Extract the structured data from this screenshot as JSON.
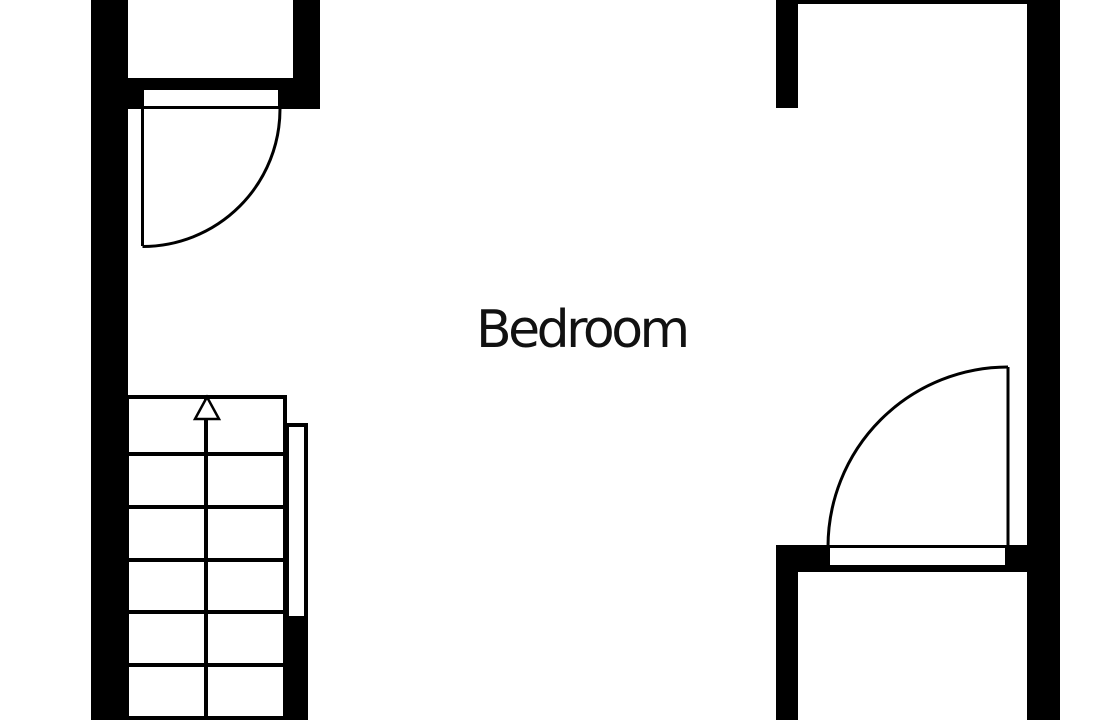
{
  "floorplan": {
    "room_label": "Bedroom",
    "colors": {
      "wall": "#000000",
      "floor": "#ffffff",
      "label_text": "#111111"
    },
    "stairs": {
      "direction": "up",
      "visible_step_rows": 6,
      "columns": 2,
      "arrow_icon": "up-arrow"
    },
    "doors": {
      "top_left_door": {
        "type": "swing",
        "state": "open"
      },
      "bottom_right_door": {
        "type": "swing",
        "state": "open"
      }
    }
  }
}
